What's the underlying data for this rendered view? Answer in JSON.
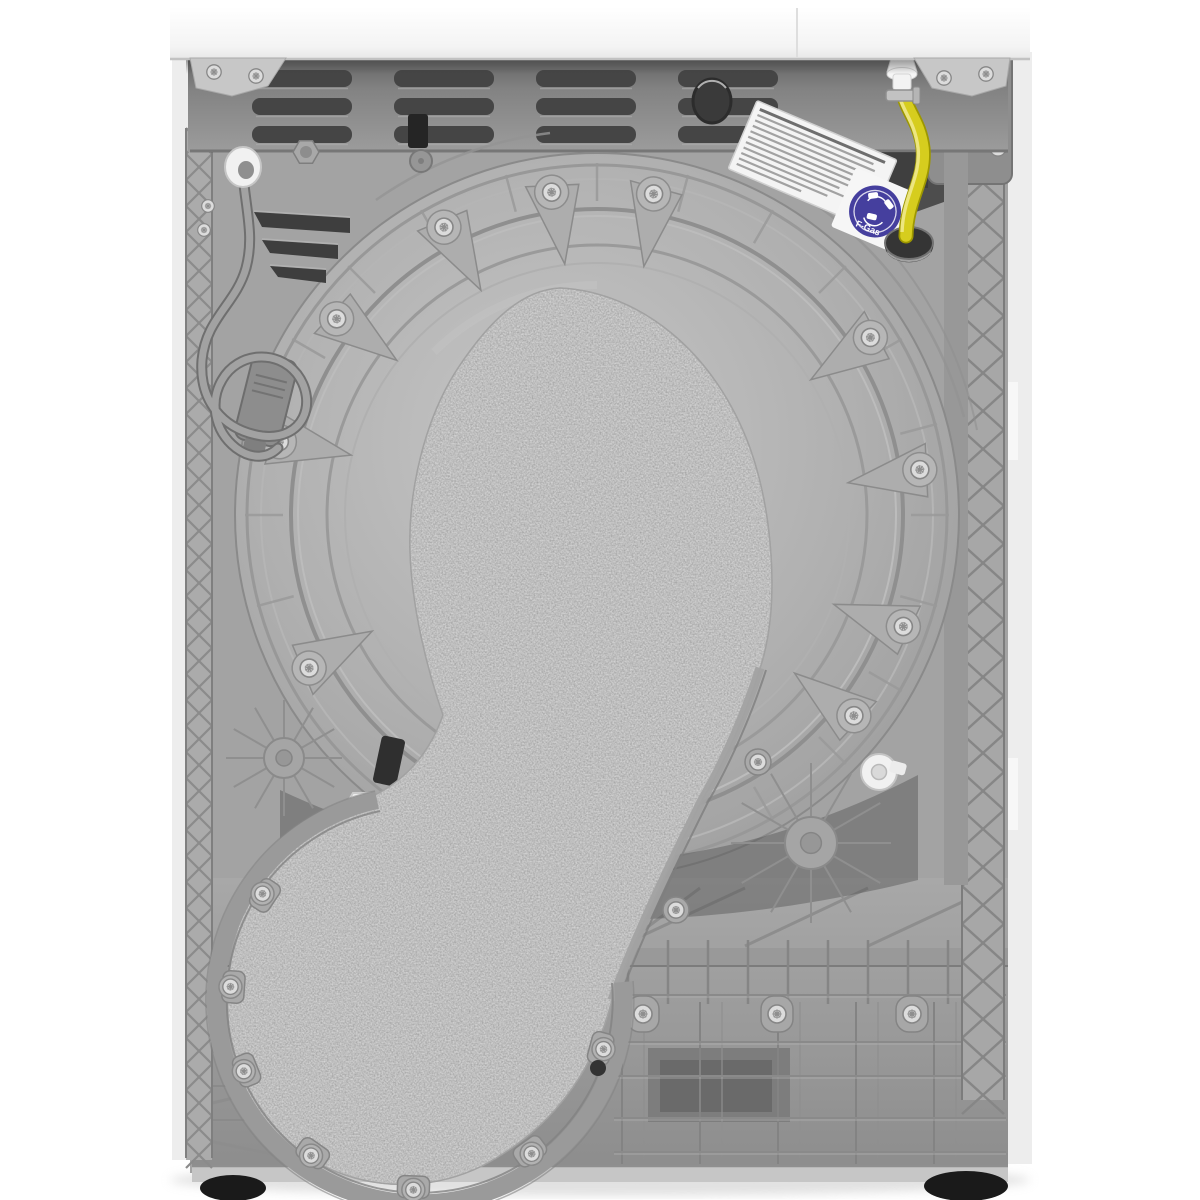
{
  "scene": {
    "type": "product-photograph",
    "subject": "Rear view of a white freestanding tumble dryer showing its grey plastic back panel",
    "background_color": "#ffffff"
  },
  "parts": {
    "top_lid": {
      "name": "white worktop",
      "color": "#f7f7f7"
    },
    "vent_panel": {
      "name": "upper metal vent panel",
      "color": "#868686",
      "slot_color": "#454545",
      "slot_rows": 3,
      "slot_columns": 4
    },
    "back_cover": {
      "name": "moulded plastic rear cover",
      "color": "#a3a3a3"
    },
    "drum_cover": {
      "name": "round drum back cover",
      "color": "#a8a8a8"
    },
    "felt_cover": {
      "name": "felt covered condenser duct",
      "color": "#d6d6d6"
    },
    "base_panel": {
      "name": "plastic base with rib grid",
      "color": "#9a9a9a"
    },
    "feet": {
      "name": "adjustable feet",
      "color": "#1a1a1a",
      "visible_count": 2
    },
    "power_cord": {
      "name": "coiled power cord with plug",
      "color": "#a2a2a2"
    },
    "drain_hose": {
      "name": "yellow drain hose",
      "color": "#d6cd1e",
      "highlight_color": "#efe98b",
      "fitting_color": "#f3f3f3"
    },
    "rating_label": {
      "name": "rating plate label",
      "color": "#f4f4f4"
    },
    "fgas_sticker": {
      "text": "F-Gas",
      "background_color": "#453f9e",
      "text_color": "#ffffff"
    }
  }
}
